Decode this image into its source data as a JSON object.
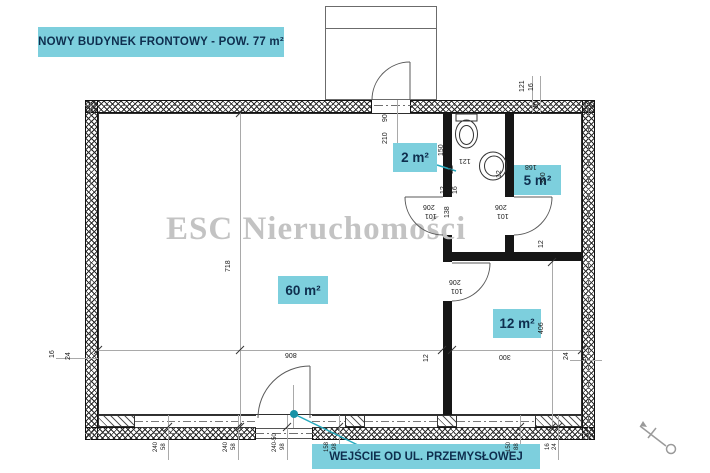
{
  "title": "NOWY BUDYNEK FRONTOWY - POW. 77 m²",
  "watermark": "ESC Nieruchomości",
  "entrance_label": "WEJŚCIE OD UL. PRZEMYSŁOWEJ",
  "colors": {
    "label_bg": "#7dcfdd",
    "label_text": "#0e2e4e",
    "leader": "#25a9bd",
    "leader_dot": "#1792a6",
    "watermark": "#c3c3c3",
    "wall": "#161616"
  },
  "rooms": [
    {
      "name": "room-label-2m2",
      "label": "2 m²",
      "x": 393,
      "y": 143,
      "w": 44,
      "h": 29
    },
    {
      "name": "room-label-5m2",
      "label": "5 m²",
      "x": 514,
      "y": 165,
      "w": 47,
      "h": 30
    },
    {
      "name": "room-label-60m2",
      "label": "60 m²",
      "x": 278,
      "y": 276,
      "w": 50,
      "h": 28
    },
    {
      "name": "room-label-12m2",
      "label": "12 m²",
      "x": 493,
      "y": 309,
      "w": 48,
      "h": 29
    }
  ],
  "doors": [
    {
      "name": "door-d2",
      "label": "D2"
    }
  ],
  "dimensions": [
    {
      "t": "90",
      "x": 390,
      "y": 114,
      "r": "ccw"
    },
    {
      "t": "210",
      "x": 390,
      "y": 136,
      "r": "ccw"
    },
    {
      "t": "150",
      "x": 446,
      "y": 148,
      "r": "ccw"
    },
    {
      "t": "12",
      "x": 504,
      "y": 170,
      "r": "ccw"
    },
    {
      "t": "40",
      "x": 541,
      "y": 101,
      "r": "ccw"
    },
    {
      "t": "121",
      "x": 527,
      "y": 84,
      "r": "ccw"
    },
    {
      "t": "16",
      "x": 536,
      "y": 83,
      "r": "ccw"
    },
    {
      "t": "D2",
      "x": 456,
      "y": 166,
      "r": "ccw"
    },
    {
      "t": "12",
      "x": 448,
      "y": 186,
      "r": "ccw"
    },
    {
      "t": "246",
      "x": 454,
      "y": 188,
      "r": "ccw"
    },
    {
      "t": "16",
      "x": 460,
      "y": 186,
      "r": "ccw"
    },
    {
      "t": "138",
      "x": 452,
      "y": 210,
      "r": "ccw"
    },
    {
      "t": "718",
      "x": 233,
      "y": 264,
      "r": "ccw"
    },
    {
      "t": "300",
      "x": 548,
      "y": 176,
      "r": "ccw"
    },
    {
      "t": "12",
      "x": 546,
      "y": 240,
      "r": "ccw"
    },
    {
      "t": "406",
      "x": 546,
      "y": 326,
      "r": "ccw"
    },
    {
      "t": "12",
      "x": 431,
      "y": 354,
      "r": "ccw"
    },
    {
      "t": "16",
      "x": 57,
      "y": 350,
      "r": "ccw"
    },
    {
      "t": "24",
      "x": 73,
      "y": 352,
      "r": "ccw"
    },
    {
      "t": "24",
      "x": 571,
      "y": 352,
      "r": "ccw"
    },
    {
      "t": "16",
      "x": 589,
      "y": 354,
      "r": "ccw"
    },
    {
      "t": "121",
      "x": 459,
      "y": 156,
      "r": "flip"
    },
    {
      "t": "168",
      "x": 525,
      "y": 162,
      "r": "flip"
    },
    {
      "t": "206",
      "x": 423,
      "y": 202,
      "r": "flip"
    },
    {
      "t": "101",
      "x": 425,
      "y": 211,
      "r": "flip"
    },
    {
      "t": "206",
      "x": 495,
      "y": 202,
      "r": "flip"
    },
    {
      "t": "101",
      "x": 497,
      "y": 211,
      "r": "flip"
    },
    {
      "t": "206",
      "x": 449,
      "y": 277,
      "r": "flip"
    },
    {
      "t": "101",
      "x": 451,
      "y": 286,
      "r": "flip"
    },
    {
      "t": "806",
      "x": 285,
      "y": 350,
      "r": "flip"
    },
    {
      "t": "300",
      "x": 499,
      "y": 352,
      "r": "flip"
    },
    {
      "t": "240",
      "x": 160,
      "y": 444,
      "r": "ccw",
      "s": 6
    },
    {
      "t": "58",
      "x": 168,
      "y": 442,
      "r": "ccw",
      "s": 6
    },
    {
      "t": "240",
      "x": 230,
      "y": 444,
      "r": "ccw",
      "s": 6
    },
    {
      "t": "58",
      "x": 238,
      "y": 442,
      "r": "ccw",
      "s": 6
    },
    {
      "t": "240-50",
      "x": 279,
      "y": 444,
      "r": "ccw",
      "s": 6
    },
    {
      "t": "98",
      "x": 287,
      "y": 442,
      "r": "ccw",
      "s": 6
    },
    {
      "t": "158",
      "x": 331,
      "y": 444,
      "r": "ccw",
      "s": 6
    },
    {
      "t": "98",
      "x": 339,
      "y": 442,
      "r": "ccw",
      "s": 6
    },
    {
      "t": "150",
      "x": 513,
      "y": 444,
      "r": "ccw",
      "s": 6
    },
    {
      "t": "88",
      "x": 521,
      "y": 442,
      "r": "ccw",
      "s": 6
    },
    {
      "t": "16",
      "x": 552,
      "y": 442,
      "r": "ccw",
      "s": 6
    },
    {
      "t": "24",
      "x": 559,
      "y": 442,
      "r": "ccw",
      "s": 6
    }
  ]
}
